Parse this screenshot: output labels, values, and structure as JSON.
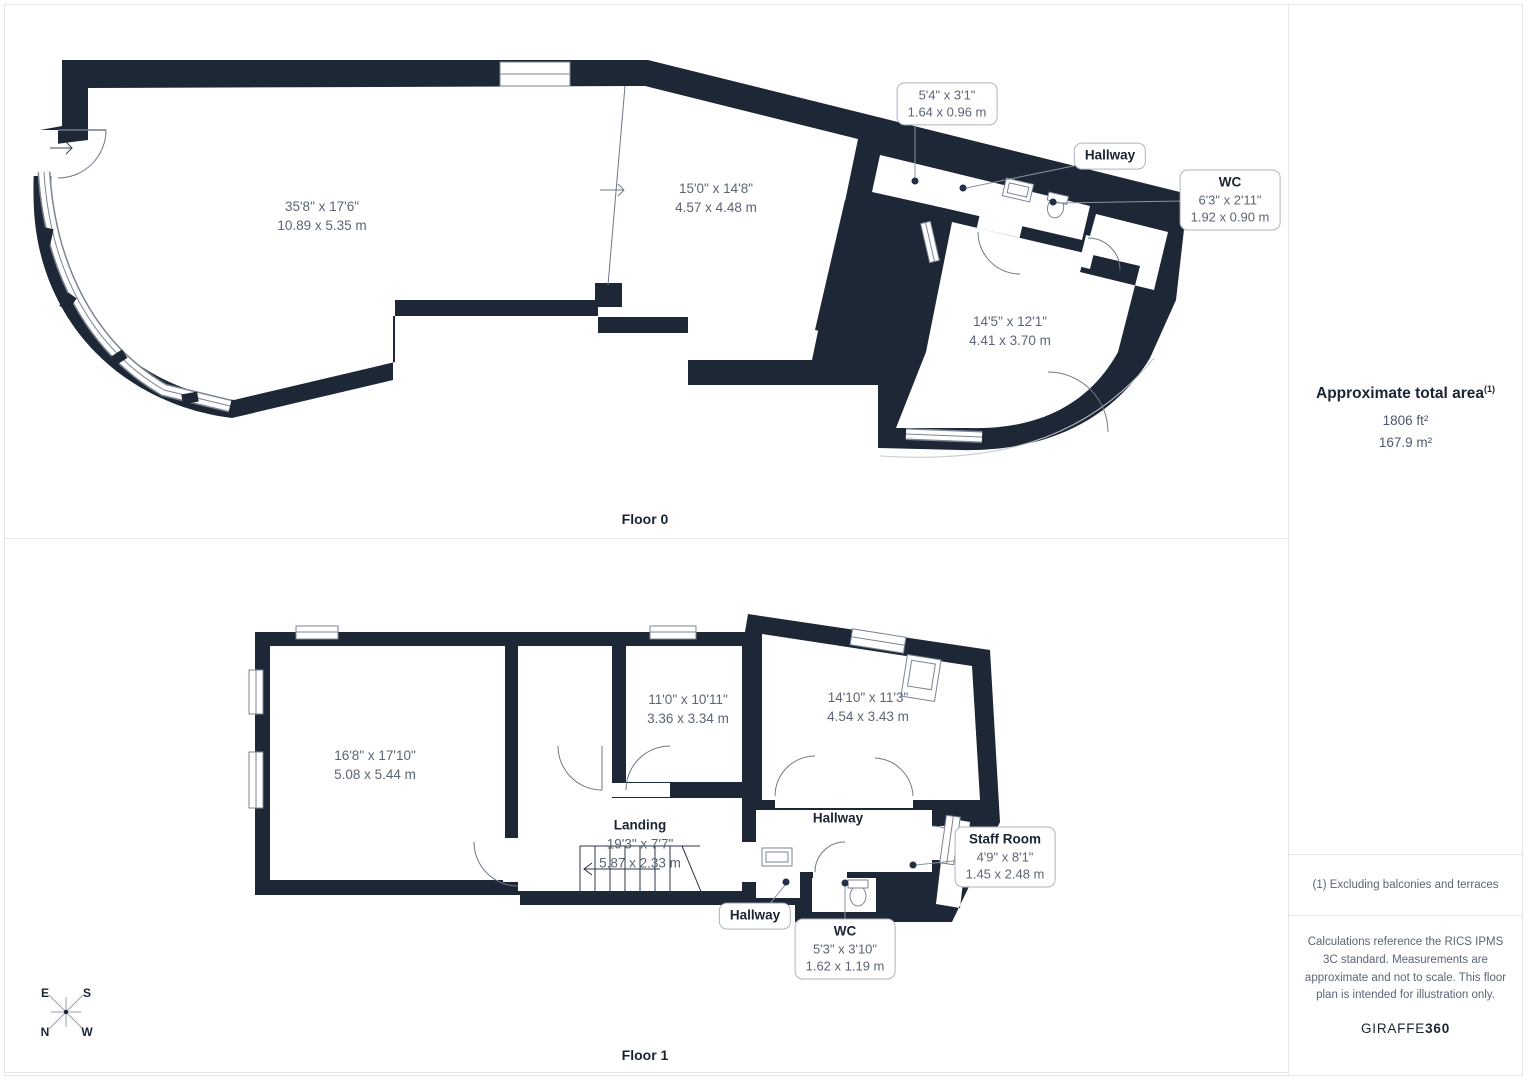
{
  "colors": {
    "wall": "#1e2736",
    "dim_text": "#5b6575",
    "dark_text": "#1b2433"
  },
  "floor0": {
    "caption": "Floor 0",
    "rooms": [
      {
        "imperial": "35'8\" x 17'6\"",
        "metric": "10.89 x 5.35 m"
      },
      {
        "imperial": "15'0\" x 14'8\"",
        "metric": "4.57 x 4.48 m"
      },
      {
        "imperial": "14'5\" x 12'1\"",
        "metric": "4.41 x 3.70 m"
      }
    ],
    "callout_dim": {
      "imperial": "5'4\" x 3'1\"",
      "metric": "1.64 x 0.96 m"
    },
    "callout_hallway": {
      "title": "Hallway"
    },
    "callout_wc": {
      "title": "WC",
      "imperial": "6'3\" x 2'11\"",
      "metric": "1.92 x 0.90 m"
    }
  },
  "floor1": {
    "caption": "Floor 1",
    "rooms": [
      {
        "imperial": "16'8\" x 17'10\"",
        "metric": "5.08 x 5.44 m"
      },
      {
        "imperial": "11'0\" x 10'11\"",
        "metric": "3.36 x 3.34 m"
      },
      {
        "imperial": "14'10\" x 11'3\"",
        "metric": "4.54 x 3.43 m"
      }
    ],
    "landing": {
      "title": "Landing",
      "imperial": "19'3\" x 7'7\"",
      "metric": "5.87 x 2.33 m"
    },
    "hallway_label": "Hallway",
    "callout_hallway": {
      "title": "Hallway"
    },
    "callout_wc": {
      "title": "WC",
      "imperial": "5'3\" x 3'10\"",
      "metric": "1.62 x 1.19 m"
    },
    "callout_staff": {
      "title": "Staff Room",
      "imperial": "4'9\" x 8'1\"",
      "metric": "1.45 x 2.48 m"
    }
  },
  "sidebar": {
    "area_title": "Approximate total area",
    "footnote_mark": "(1)",
    "area_imperial": "1806 ft²",
    "area_metric": "167.9 m²",
    "footnote": "(1) Excluding balconies and terraces",
    "disclaimer": "Calculations reference the RICS IPMS 3C standard. Measurements are approximate and not to scale. This floor plan is intended for illustration only.",
    "brand_name": "GIRAFFE",
    "brand_suffix": "360"
  },
  "compass": {
    "e": "E",
    "s": "S",
    "n": "N",
    "w": "W"
  }
}
